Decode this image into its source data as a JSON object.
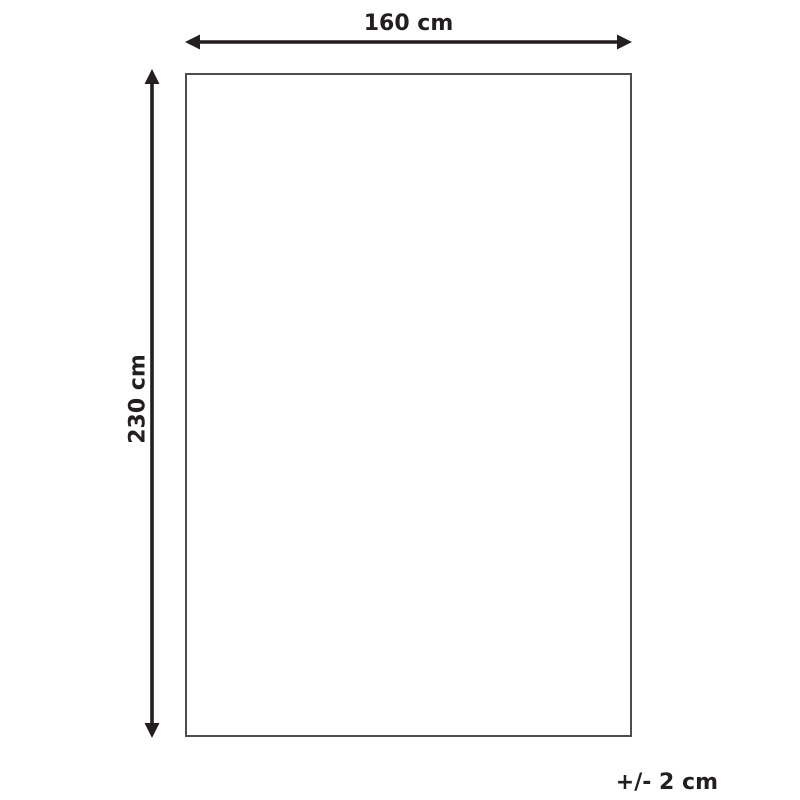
{
  "diagram": {
    "title": "product-dimension-diagram",
    "width_label": "160 cm",
    "height_label": "230 cm",
    "tolerance_label": "+/- 2 cm",
    "dimensions": {
      "width_cm": 160,
      "height_cm": 230,
      "tolerance_cm": 2
    }
  },
  "colors": {
    "arrow": "#231f20",
    "text": "#231f20",
    "rectangle_border": "#4d4d4d",
    "background": "#ffffff"
  }
}
